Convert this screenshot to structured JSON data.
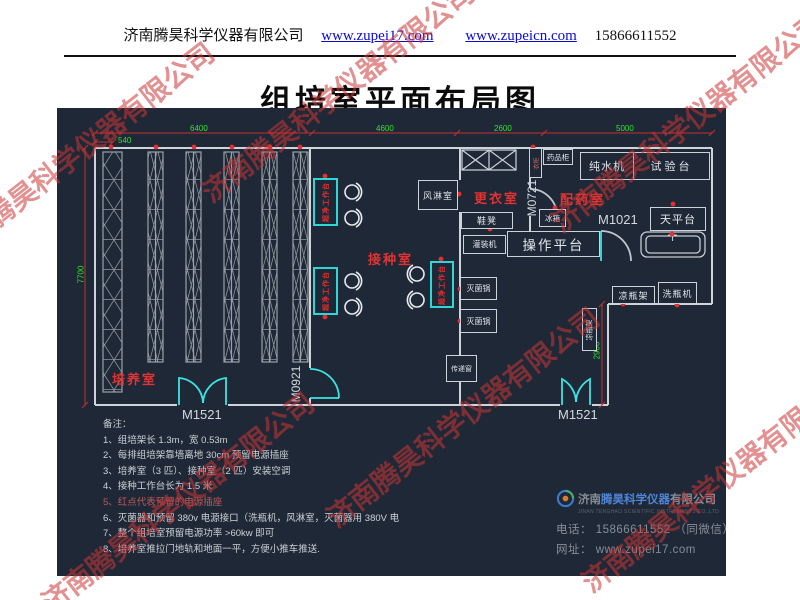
{
  "header": {
    "company": "济南腾昊科学仪器有限公司",
    "link1": "www.zupei17.com",
    "link2": "www.zupeicn.com",
    "phone": "15866611552"
  },
  "title": "组培室平面布局图",
  "watermark": "济南腾昊科学仪器有限公司",
  "plan": {
    "rooms": {
      "culture": "培养室",
      "inoculation": "接种室",
      "changing": "更衣室",
      "dispensing": "配药室"
    },
    "doors": {
      "m1521": "M1521",
      "m0921": "M0921",
      "m0721": "M0721",
      "m1021": "M1021"
    },
    "dimensions": {
      "d540": "540",
      "d6400": "6400",
      "d4600": "4600",
      "d2600": "2600",
      "d5000": "5000",
      "d7700": "7700",
      "d2900": "2900"
    },
    "equipment": {
      "air_shower": "风淋室",
      "wardrobe": "衣柜",
      "medicine_cabinet": "药品柜",
      "pure_water": "纯水机",
      "test_bench": "试验台",
      "balance": "天平台",
      "fridge": "冰箱",
      "shoe_bench": "鞋凳",
      "filling_machine": "灌装机",
      "operation_platform": "操作平台",
      "sterilizer": "灭菌锅",
      "pass_window": "传递窗",
      "bottle_rack": "凉瓶架",
      "bottle_washer": "洗瓶机",
      "clean_bench": "超净工作台"
    }
  },
  "notes": {
    "title": "备注：",
    "items": [
      "1、组培架长 1.3m，宽 0.53m",
      "2、每排组培架靠墙离地 30cm 预留电源插座",
      "3、培养室（3 匹）、接种室（2 匹）安装空调",
      "4、接种工作台长为 1.5 米",
      "5、红点代表预留的电源插座",
      "6、灭菌器和预留 380v 电源接口（洗瓶机，风淋室，灭菌器用 380V 电",
      "7、整个组培室预留电源功率 >60kw 即可",
      "8、培养室推拉门地轨和地面一平，方便小推车推送."
    ]
  },
  "footer": {
    "brand_prefix": "济南",
    "brand_name": "腾昊科学仪器",
    "brand_suffix": "有限公司",
    "brand_en": "JINAN TENGHAO SCIENTIFIC INSTRUMENTS CO.,LTD",
    "phone_line": "电话： 15866611552 （同微信）",
    "web_line": "网址： www.zupei17.com"
  }
}
